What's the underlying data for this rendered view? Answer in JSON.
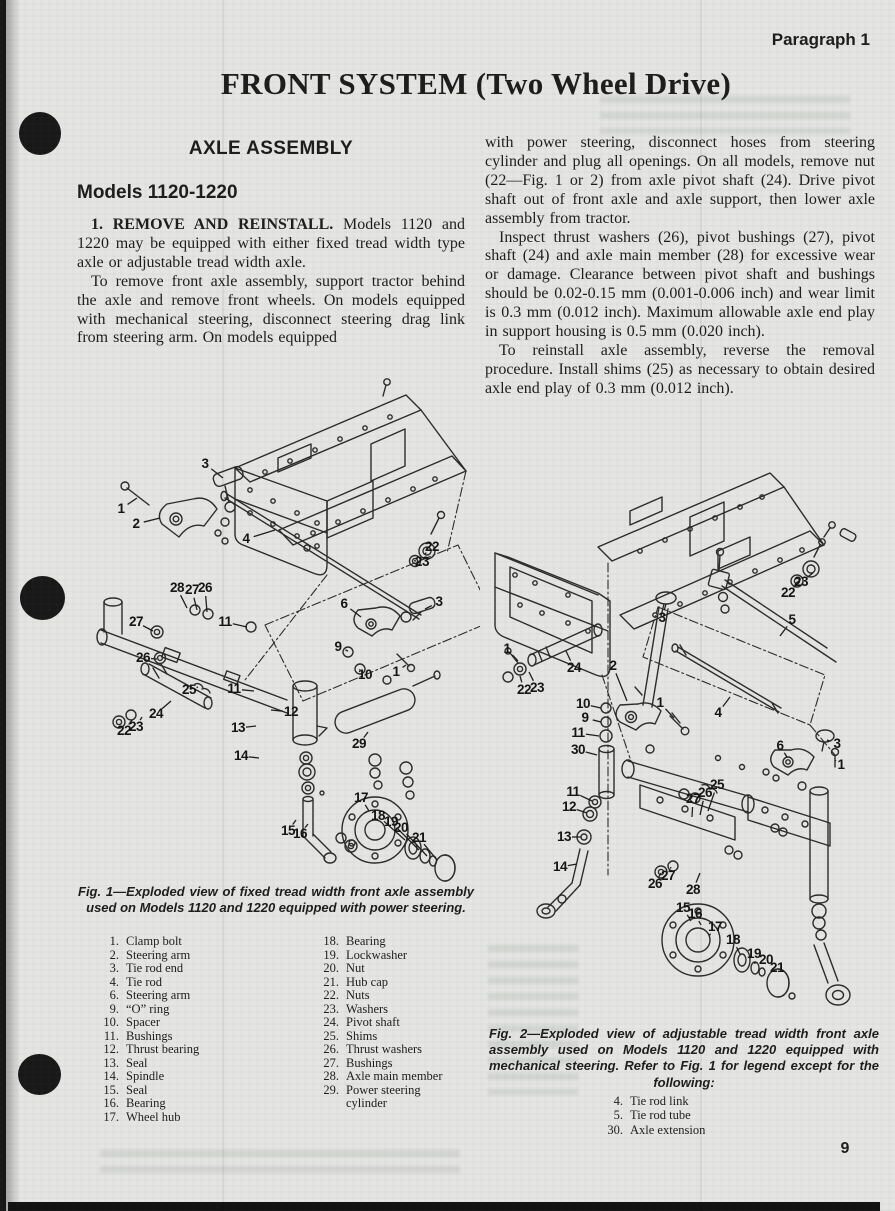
{
  "colors": {
    "paper": "#e5e6e3",
    "ink": "#1c1c1c",
    "punch_black": "#181818",
    "footer_band": "#111111"
  },
  "page": {
    "header_right": "Paragraph 1",
    "title": "FRONT SYSTEM (Two Wheel Drive)",
    "page_number": "9"
  },
  "left_column": {
    "section_heading": "AXLE ASSEMBLY",
    "subheading": "Models 1120-1220",
    "para1_lead": "1.  REMOVE AND REINSTALL.",
    "para1_rest": " Models 1120 and 1220 may be equipped with either fixed tread width type axle or adjustable tread width axle.",
    "para2": "To remove front axle assembly, support tractor behind the axle and remove front wheels. On models equipped with mechanical steering, disconnect steering drag link from steering arm. On models equipped"
  },
  "right_column": {
    "para1": "with power steering, disconnect hoses from steering cylinder and plug all openings. On all models, remove nut (22—Fig. 1 or 2) from axle pivot shaft (24). Drive pivot shaft out of front axle and axle support, then lower axle assembly from tractor.",
    "para2": "Inspect thrust washers (26), pivot bushings (27), pivot shaft (24) and axle main member (28) for excessive wear or damage. Clearance between pivot shaft and bushings should be 0.02-0.15 mm (0.001-0.006 inch) and wear limit is 0.3 mm (0.012 inch). Maximum allowable axle end play in support housing is 0.5 mm (0.020 inch).",
    "para3": "To reinstall axle assembly, reverse the removal procedure. Install shims (25) as necessary to obtain desired axle end play of 0.3 mm (0.012 inch)."
  },
  "fig1": {
    "caption": "Fig. 1—Exploded view of fixed tread width front axle assembly used on Models 1120 and 1220 equipped with power steering.",
    "callouts": [
      {
        "n": "3",
        "x": 130,
        "y": 96,
        "lx": 148,
        "ly": 110
      },
      {
        "n": "1",
        "x": 46,
        "y": 141,
        "lx": 62,
        "ly": 130
      },
      {
        "n": "2",
        "x": 61,
        "y": 156,
        "lx": 85,
        "ly": 150
      },
      {
        "n": "4",
        "x": 171,
        "y": 171,
        "lx": 200,
        "ly": 162
      },
      {
        "n": "22",
        "x": 357,
        "y": 179,
        "lx": 350,
        "ly": 186
      },
      {
        "n": "23",
        "x": 347,
        "y": 194,
        "lx": 341,
        "ly": 193
      },
      {
        "n": "28",
        "x": 102,
        "y": 220,
        "lx": 112,
        "ly": 240
      },
      {
        "n": "27",
        "x": 117,
        "y": 222,
        "lx": 122,
        "ly": 242
      },
      {
        "n": "26",
        "x": 130,
        "y": 220,
        "lx": 132,
        "ly": 244
      },
      {
        "n": "27",
        "x": 61,
        "y": 254,
        "lx": 78,
        "ly": 263
      },
      {
        "n": "11",
        "x": 150,
        "y": 254,
        "lx": 172,
        "ly": 259
      },
      {
        "n": "6",
        "x": 269,
        "y": 236,
        "lx": 286,
        "ly": 249
      },
      {
        "n": "3",
        "x": 364,
        "y": 234,
        "lx": 350,
        "ly": 241
      },
      {
        "n": "9",
        "x": 263,
        "y": 279,
        "lx": 273,
        "ly": 283
      },
      {
        "n": "26",
        "x": 68,
        "y": 290,
        "lx": 82,
        "ly": 291
      },
      {
        "n": "10",
        "x": 290,
        "y": 307,
        "lx": 285,
        "ly": 302
      },
      {
        "n": "1",
        "x": 321,
        "y": 304,
        "lx": 331,
        "ly": 297
      },
      {
        "n": "25",
        "x": 114,
        "y": 322,
        "lx": 123,
        "ly": 319
      },
      {
        "n": "24",
        "x": 81,
        "y": 346,
        "lx": 96,
        "ly": 333
      },
      {
        "n": "11",
        "x": 159,
        "y": 321,
        "lx": 179,
        "ly": 323
      },
      {
        "n": "12",
        "x": 216,
        "y": 344,
        "lx": 196,
        "ly": 342
      },
      {
        "n": "22",
        "x": 49,
        "y": 363,
        "lx": 57,
        "ly": 352
      },
      {
        "n": "23",
        "x": 61,
        "y": 359,
        "lx": 67,
        "ly": 349
      },
      {
        "n": "13",
        "x": 163,
        "y": 360,
        "lx": 181,
        "ly": 358
      },
      {
        "n": "29",
        "x": 284,
        "y": 376,
        "lx": 293,
        "ly": 364
      },
      {
        "n": "14",
        "x": 166,
        "y": 388,
        "lx": 184,
        "ly": 390
      },
      {
        "n": "17",
        "x": 286,
        "y": 430,
        "lx": 294,
        "ly": 443
      },
      {
        "n": "15",
        "x": 213,
        "y": 463,
        "lx": 221,
        "ly": 452
      },
      {
        "n": "16",
        "x": 225,
        "y": 466,
        "lx": 233,
        "ly": 456
      },
      {
        "n": "18",
        "x": 303,
        "y": 448,
        "lx": 330,
        "ly": 472
      },
      {
        "n": "19",
        "x": 316,
        "y": 454,
        "lx": 344,
        "ly": 482
      },
      {
        "n": "20",
        "x": 326,
        "y": 460,
        "lx": 352,
        "ly": 488
      },
      {
        "n": "21",
        "x": 344,
        "y": 470,
        "lx": 362,
        "ly": 492
      }
    ]
  },
  "legend": {
    "col1": [
      {
        "num": "1.",
        "label": "Clamp bolt"
      },
      {
        "num": "2.",
        "label": "Steering arm"
      },
      {
        "num": "3.",
        "label": "Tie rod end"
      },
      {
        "num": "4.",
        "label": "Tie rod"
      },
      {
        "num": "6.",
        "label": "Steering arm"
      },
      {
        "num": "9.",
        "label": "“O” ring"
      },
      {
        "num": "10.",
        "label": "Spacer"
      },
      {
        "num": "11.",
        "label": "Bushings"
      },
      {
        "num": "12.",
        "label": "Thrust bearing"
      },
      {
        "num": "13.",
        "label": "Seal"
      },
      {
        "num": "14.",
        "label": "Spindle"
      },
      {
        "num": "15.",
        "label": "Seal"
      },
      {
        "num": "16.",
        "label": "Bearing"
      },
      {
        "num": "17.",
        "label": "Wheel hub"
      }
    ],
    "col2": [
      {
        "num": "18.",
        "label": "Bearing"
      },
      {
        "num": "19.",
        "label": "Lockwasher"
      },
      {
        "num": "20.",
        "label": "Nut"
      },
      {
        "num": "21.",
        "label": "Hub cap"
      },
      {
        "num": "22.",
        "label": "Nuts"
      },
      {
        "num": "23.",
        "label": "Washers"
      },
      {
        "num": "24.",
        "label": "Pivot shaft"
      },
      {
        "num": "25.",
        "label": "Shims"
      },
      {
        "num": "26.",
        "label": "Thrust washers"
      },
      {
        "num": "27.",
        "label": "Bushings"
      },
      {
        "num": "28.",
        "label": "Axle main member"
      },
      {
        "num": "29.",
        "label": "Power steering cylinder"
      }
    ]
  },
  "fig2": {
    "caption": "Fig. 2—Exploded view of adjustable tread width front axle assembly used on Models 1120 and 1220 equipped with mechanical steering. Refer to Fig. 1 for legend except for the following:",
    "extra_legend": [
      {
        "num": "4.",
        "label": "Tie rod link"
      },
      {
        "num": "5.",
        "label": "Tie rod tube"
      },
      {
        "num": "30.",
        "label": "Axle extension"
      }
    ],
    "callouts": [
      {
        "n": "23",
        "x": 321,
        "y": 127,
        "lx": 333,
        "ly": 118
      },
      {
        "n": "22",
        "x": 308,
        "y": 138,
        "lx": 319,
        "ly": 127
      },
      {
        "n": "1",
        "x": 27,
        "y": 194,
        "lx": 38,
        "ly": 206
      },
      {
        "n": "22",
        "x": 44,
        "y": 235,
        "lx": 40,
        "ly": 221
      },
      {
        "n": "23",
        "x": 57,
        "y": 233,
        "lx": 49,
        "ly": 217
      },
      {
        "n": "24",
        "x": 94,
        "y": 213,
        "lx": 86,
        "ly": 196
      },
      {
        "n": "2",
        "x": 133,
        "y": 211,
        "lx": 147,
        "ly": 246
      },
      {
        "n": "3",
        "x": 182,
        "y": 163,
        "lx": 186,
        "ly": 149
      },
      {
        "n": "5",
        "x": 312,
        "y": 165,
        "lx": 300,
        "ly": 181
      },
      {
        "n": "4",
        "x": 238,
        "y": 258,
        "lx": 250,
        "ly": 242
      },
      {
        "n": "10",
        "x": 103,
        "y": 249,
        "lx": 121,
        "ly": 253
      },
      {
        "n": "9",
        "x": 105,
        "y": 263,
        "lx": 121,
        "ly": 267
      },
      {
        "n": "11",
        "x": 98,
        "y": 278,
        "lx": 119,
        "ly": 281
      },
      {
        "n": "1",
        "x": 180,
        "y": 248,
        "lx": 194,
        "ly": 263
      },
      {
        "n": "30",
        "x": 98,
        "y": 295,
        "lx": 117,
        "ly": 300
      },
      {
        "n": "6",
        "x": 300,
        "y": 291,
        "lx": 307,
        "ly": 302
      },
      {
        "n": "3",
        "x": 357,
        "y": 289,
        "lx": 347,
        "ly": 285
      },
      {
        "n": "1",
        "x": 361,
        "y": 310,
        "lx": 356,
        "ly": 306
      },
      {
        "n": "11",
        "x": 93,
        "y": 337,
        "lx": 112,
        "ly": 346
      },
      {
        "n": "12",
        "x": 89,
        "y": 352,
        "lx": 107,
        "ly": 358
      },
      {
        "n": "13",
        "x": 84,
        "y": 382,
        "lx": 101,
        "ly": 382
      },
      {
        "n": "14",
        "x": 80,
        "y": 412,
        "lx": 97,
        "ly": 409
      },
      {
        "n": "27",
        "x": 213,
        "y": 344,
        "lx": 212,
        "ly": 362
      },
      {
        "n": "26",
        "x": 225,
        "y": 338,
        "lx": 220,
        "ly": 360
      },
      {
        "n": "25",
        "x": 237,
        "y": 330,
        "lx": 228,
        "ly": 356
      },
      {
        "n": "26",
        "x": 175,
        "y": 429,
        "lx": 181,
        "ly": 418
      },
      {
        "n": "27",
        "x": 188,
        "y": 421,
        "lx": 191,
        "ly": 412
      },
      {
        "n": "28",
        "x": 213,
        "y": 435,
        "lx": 220,
        "ly": 418
      },
      {
        "n": "15",
        "x": 203,
        "y": 453,
        "lx": 211,
        "ly": 466
      },
      {
        "n": "16",
        "x": 215,
        "y": 459,
        "lx": 221,
        "ly": 470
      },
      {
        "n": "17",
        "x": 235,
        "y": 472,
        "lx": 229,
        "ly": 481
      },
      {
        "n": "18",
        "x": 253,
        "y": 485,
        "lx": 260,
        "ly": 499
      },
      {
        "n": "19",
        "x": 274,
        "y": 499,
        "lx": 275,
        "ly": 509
      },
      {
        "n": "20",
        "x": 286,
        "y": 505,
        "lx": 283,
        "ly": 513
      },
      {
        "n": "21",
        "x": 297,
        "y": 513,
        "lx": 296,
        "ly": 521
      }
    ]
  }
}
